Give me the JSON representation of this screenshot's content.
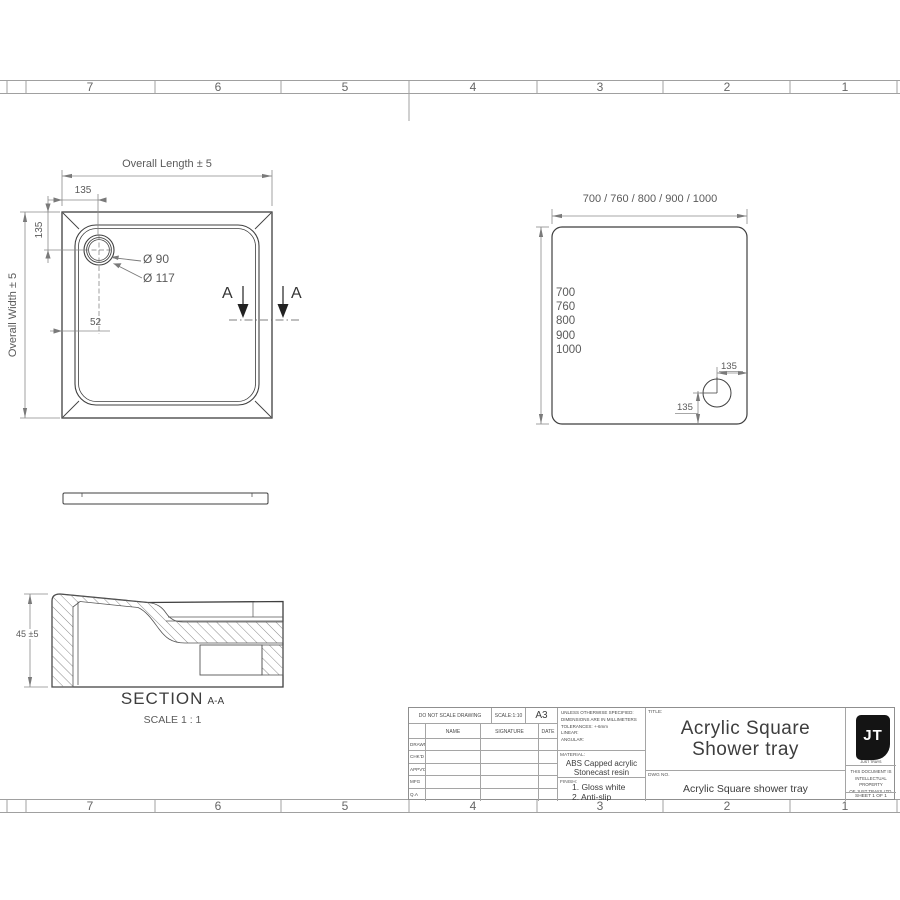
{
  "sheet": {
    "ruler_top": [
      "7",
      "6",
      "5",
      "4",
      "3",
      "2",
      "1"
    ],
    "ruler_bottom": [
      "7",
      "6",
      "5",
      "4",
      "3",
      "2",
      "1"
    ]
  },
  "plan_view": {
    "overall_length": "Overall Length ± 5",
    "overall_width": "Overall Width ± 5",
    "offset_top": "135",
    "offset_left": "135",
    "wall_dim": "52",
    "drain_inner": "Ø 90",
    "drain_outer": "Ø 117",
    "section_a_left": "A",
    "section_a_right": "A"
  },
  "size_view": {
    "width_options": "700 / 760 / 800 / 900 / 1000",
    "sizes": [
      "700",
      "760",
      "800",
      "900",
      "1000"
    ],
    "waste_offset_h": "135",
    "waste_offset_v": "135"
  },
  "section_view": {
    "label": "SECTION",
    "cut": "A-A",
    "scale": "SCALE 1 : 1",
    "height_dim": "45 ±5"
  },
  "title_block": {
    "do_not_scale": "DO NOT SCALE DRAWING",
    "scale": "SCALE:1:10",
    "paper_size": "A3",
    "col_name": "NAME",
    "col_signature": "SIGNATURE",
    "col_date": "DATE",
    "rows": [
      "DRAWN",
      "CHK'D",
      "APPV'D",
      "MFG",
      "Q.A"
    ],
    "spec_lines": [
      "UNLESS OTHERWISE SPECIFIED:",
      "DIMENSIONS ARE IN MILLIMETERS",
      "TOLERANCES: +-6mm",
      "LINEAR:",
      "ANGULAR:"
    ],
    "material_label": "MATERIAL:",
    "material_line1": "ABS Capped acrylic",
    "material_line2": "Stonecast resin",
    "finish_label": "FINISH:",
    "finish_line1": "1. Gloss white",
    "finish_line2": "2. Anti-slip available",
    "title_label": "TITLE:",
    "title_line1": "Acrylic Square",
    "title_line2": "Shower tray",
    "dwg_label": "DWG NO.",
    "dwg_value": "Acrylic Square shower tray",
    "logo": "JT",
    "logo_tagline": "JUST TRAYS",
    "property_line1": "THIS DOCUMENT IS",
    "property_line2": "INTELLECTUAL PROPERTY",
    "property_line3": "OF JUST TRAYS LTD.",
    "sheet_no": "SHEET 1 OF 1"
  },
  "colors": {
    "line_main": "#3f3f3f",
    "line_dim": "#8a8a8a",
    "text_dim": "#5a5a5a",
    "logo_bg": "#141414"
  }
}
